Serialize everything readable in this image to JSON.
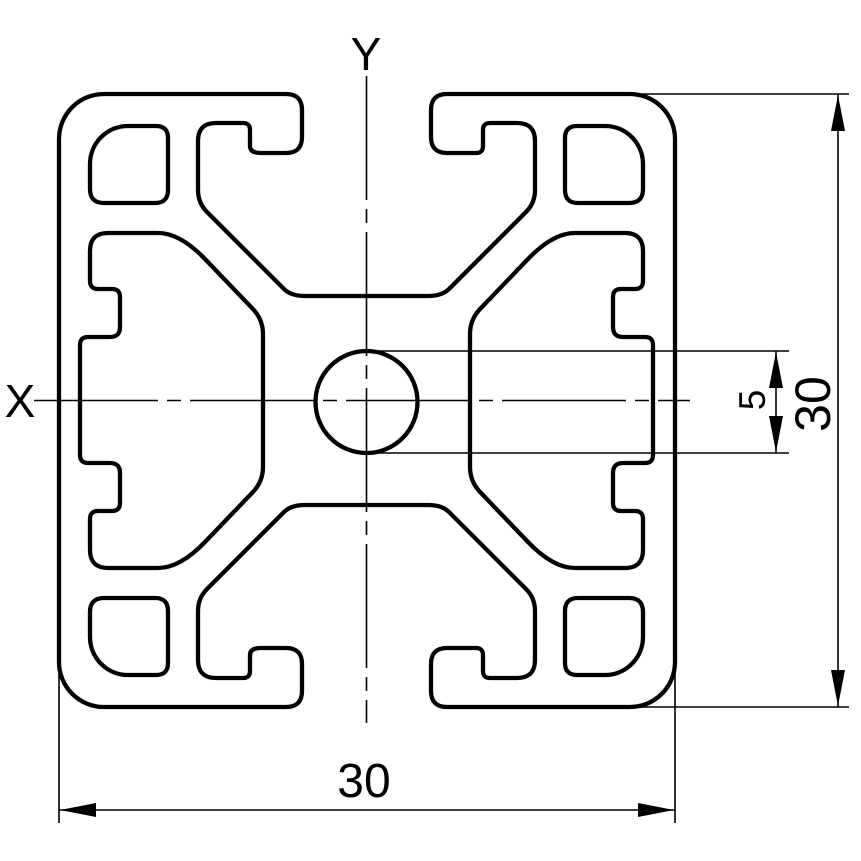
{
  "drawing": {
    "axis": {
      "x_label": "X",
      "y_label": "Y"
    },
    "dimensions": {
      "hole_diameter": "5",
      "profile_height": "30",
      "profile_width": "30"
    },
    "colors": {
      "line": "#000000",
      "background": "#ffffff"
    }
  }
}
